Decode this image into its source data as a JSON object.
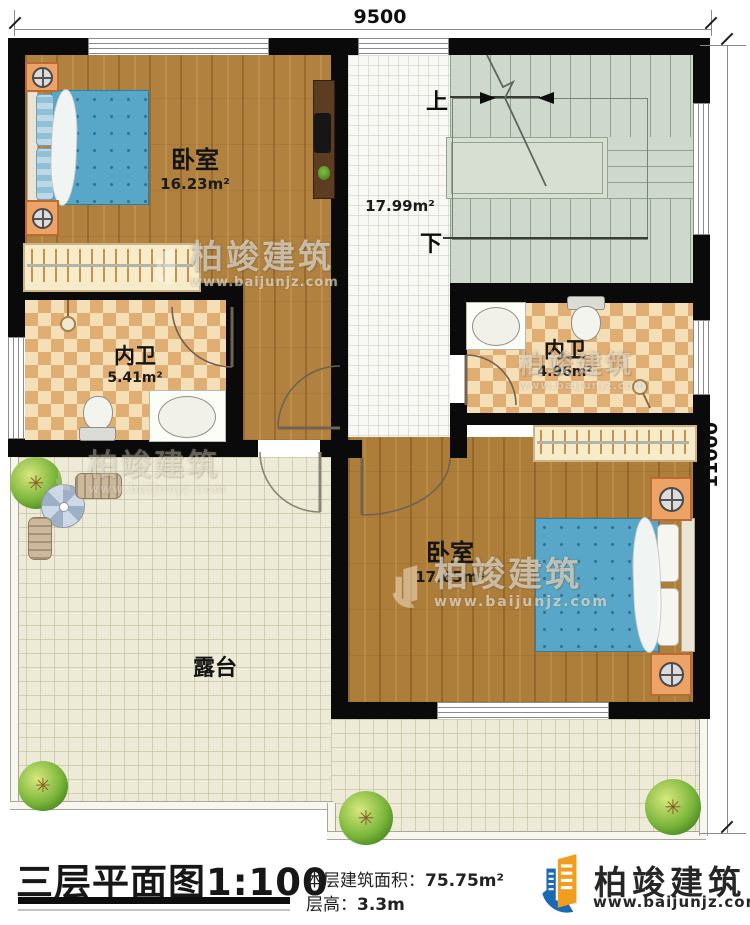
{
  "dimensions": {
    "top": "9500",
    "right": "11000"
  },
  "rooms": {
    "bedroom1": {
      "name": "卧室",
      "area": "16.23m²"
    },
    "stair_hall": {
      "area": "17.99m²",
      "up": "上",
      "down": "下"
    },
    "bath_left": {
      "name": "内卫",
      "area": "5.41m²"
    },
    "bath_right": {
      "name": "内卫",
      "area": "4.96m²"
    },
    "bedroom2": {
      "name": "卧室",
      "area": "17.65m²"
    },
    "terrace": {
      "name": "露台"
    }
  },
  "watermark": {
    "brand": "柏竣建筑",
    "url": "www.baijunjz.com"
  },
  "footer": {
    "title": "三层平面图",
    "scale": "1:100",
    "area_label": "本层建筑面积：",
    "area_value": "75.75m²",
    "height_label": "层高：",
    "height_value": "3.3m",
    "brand": "柏竣建筑",
    "url": "www.baijunjz.com"
  },
  "colors": {
    "wall": "#0a0a0a",
    "wood_floor": "#b0813f",
    "stair": "#cfd8cd",
    "terrace": "#edead7",
    "bathroom_tile_dark": "#e0ad72",
    "bathroom_tile_light": "#f4dfb6",
    "bed_blue": "#5ea8c9",
    "logo_blue": "#1b6ab1",
    "logo_orange": "#f29d1e"
  }
}
